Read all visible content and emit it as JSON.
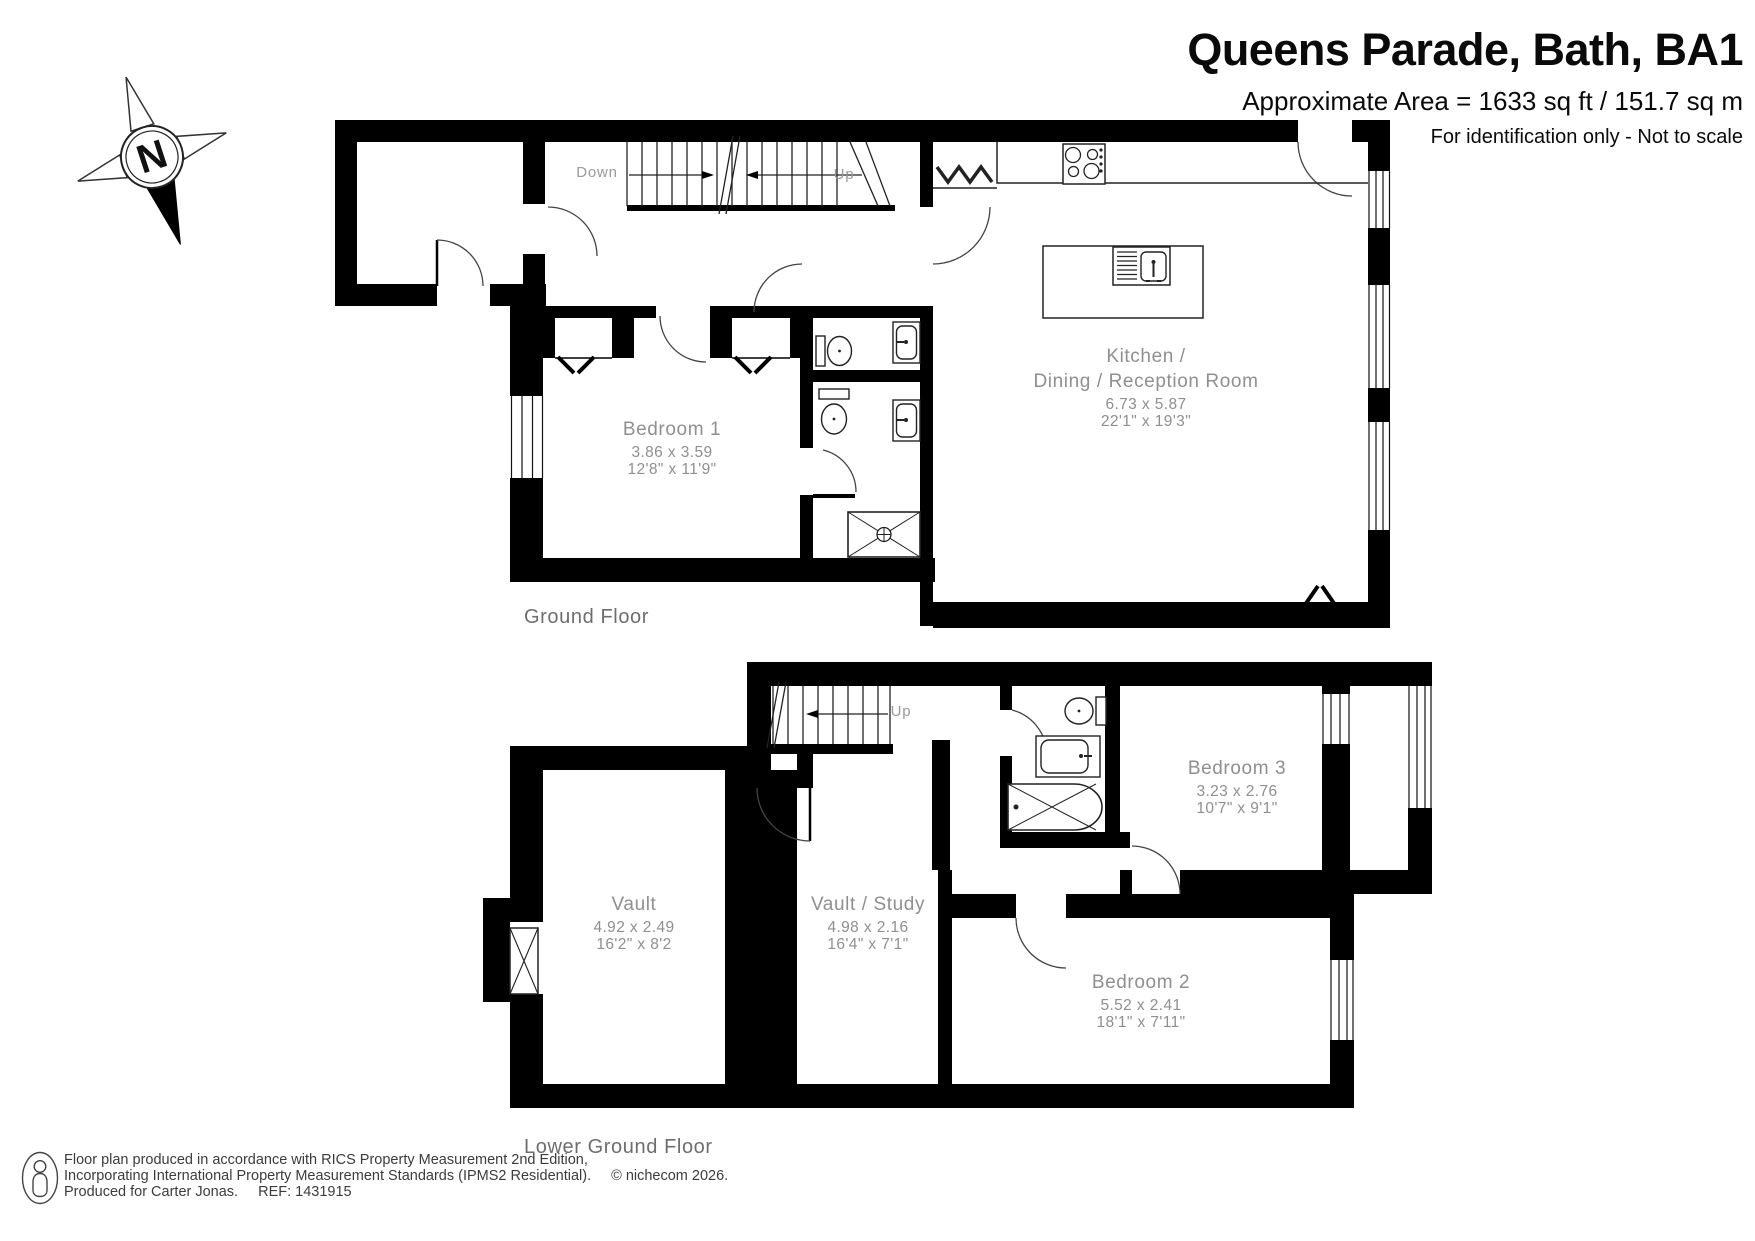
{
  "header": {
    "title": "Queens Parade, Bath, BA1",
    "area": "Approximate Area = 1633 sq ft / 151.7 sq m",
    "note": "For identification only - Not to scale"
  },
  "compass": {
    "north": "N"
  },
  "floors": {
    "ground": {
      "label": "Ground Floor",
      "stairs": {
        "down": "Down",
        "up": "Up"
      },
      "rooms": {
        "bedroom1": {
          "name": "Bedroom 1",
          "metric": "3.86 x 3.59",
          "imperial": "12'8\" x 11'9\""
        },
        "kitchen": {
          "name1": "Kitchen /",
          "name2": "Dining / Reception Room",
          "metric": "6.73 x 5.87",
          "imperial": "22'1\" x 19'3\""
        }
      }
    },
    "lower_ground": {
      "label": "Lower Ground Floor",
      "stairs": {
        "up": "Up"
      },
      "rooms": {
        "vault": {
          "name": "Vault",
          "metric": "4.92 x 2.49",
          "imperial": "16'2\" x 8'2"
        },
        "vault_study": {
          "name": "Vault / Study",
          "metric": "4.98 x 2.16",
          "imperial": "16'4\" x 7'1\""
        },
        "bedroom2": {
          "name": "Bedroom 2",
          "metric": "5.52 x 2.41",
          "imperial": "18'1\" x 7'11\""
        },
        "bedroom3": {
          "name": "Bedroom 3",
          "metric": "3.23 x 2.76",
          "imperial": "10'7\" x 9'1\""
        }
      }
    }
  },
  "footer": {
    "line1": "Floor plan produced in accordance with RICS Property Measurement 2nd Edition,",
    "line2": "Incorporating International Property Measurement Standards (IPMS2 Residential).",
    "copyright": "© nichecom 2026.",
    "produced_for": "Produced for Carter Jonas.",
    "ref": "REF: 1431915"
  }
}
